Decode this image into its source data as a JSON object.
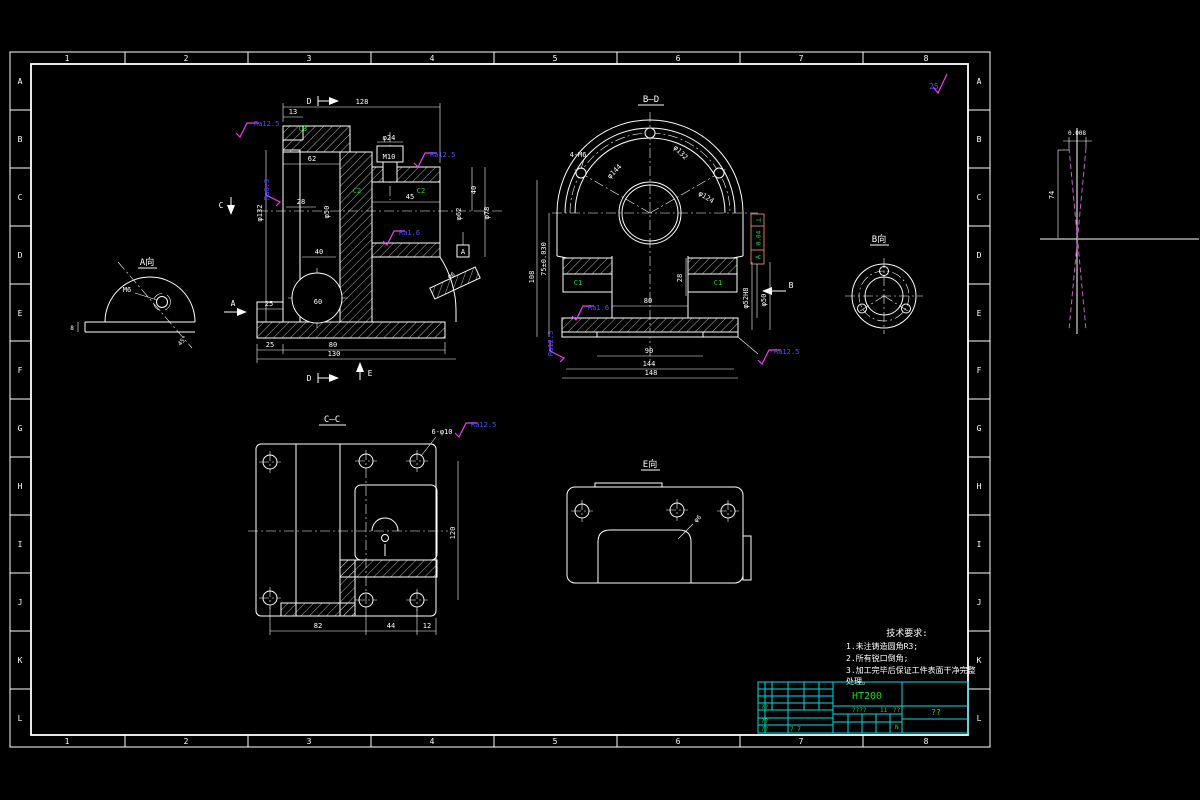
{
  "sheet": {
    "columns": [
      "1",
      "2",
      "3",
      "4",
      "5",
      "6",
      "7",
      "8"
    ],
    "rows": [
      "A",
      "B",
      "C",
      "D",
      "E",
      "F",
      "G",
      "H",
      "I",
      "J",
      "K",
      "L"
    ],
    "general_roughness": "25"
  },
  "views": {
    "front": {
      "section_d_top": "D",
      "section_d_bottom": "D",
      "section_e": "E",
      "section_c": "C",
      "view_a_arrow": "A",
      "datum": "A",
      "dims": {
        "d128": "128",
        "d13": "13",
        "d62": "62",
        "d28": "28",
        "d45": "45",
        "d40r": "40",
        "d24": "φ24",
        "m10": "M10",
        "d50": "φ50",
        "d78": "φ78",
        "d62b": "φ62",
        "d132": "φ132",
        "d40": "40",
        "d60": "60",
        "d25": "25",
        "d25b": "25",
        "d80": "80",
        "d130": "130",
        "oil": "φ6"
      },
      "chamfers": {
        "c3": "C3",
        "c2a": "C2",
        "c2b": "C2"
      },
      "finish": {
        "f1": "Ra12.5",
        "f2": "Ra6.3",
        "f3": "Ra12.5",
        "f4": "Ra1.6"
      }
    },
    "viewA": {
      "title": "A向",
      "thread": "M6",
      "angle": "45°",
      "d8": "8"
    },
    "bd": {
      "title": "B—D",
      "dims": {
        "bolt": "4-M6",
        "d144": "φ144",
        "d132": "φ132",
        "d124": "φ124",
        "h75": "75±0.030",
        "h108": "108",
        "d28": "28",
        "w80": "80",
        "w90": "90",
        "w144": "144",
        "w148": "148",
        "d52": "φ52H8",
        "d50": "φ50"
      },
      "chamfers": {
        "c1a": "C1",
        "c1b": "C1"
      },
      "gdt": {
        "sym": "⊥",
        "tol": "0.04",
        "datum": "A"
      },
      "arrow_b": "B",
      "finish": {
        "f1": "Ra12.5",
        "f2": "Ra1.6",
        "f3": "Ra12.5"
      }
    },
    "viewB": {
      "title": "B向"
    },
    "cc": {
      "title": "C—C",
      "callout": "6-φ10",
      "finish": "Ra12.5",
      "dims": {
        "w82": "82",
        "w44": "44",
        "w12": "12",
        "h120": "120"
      }
    },
    "viewE": {
      "title": "E向",
      "hole": "φ6"
    },
    "taper": {
      "tol": "0.008",
      "h74": "74"
    }
  },
  "notes": {
    "title": "技术要求:",
    "lines": [
      "1.未注铸造圆角R3;",
      "2.所有锐口倒角;",
      "3.加工完毕后保证工件表面干净完整",
      "处理。"
    ]
  },
  "title_block": {
    "material": "HT200",
    "drawing_no": "??",
    "cells": {
      "t1": "??",
      "t2": "????",
      "t3": "11",
      "t4": "??",
      "t5": "N",
      "t6": "??",
      "t7": "??",
      "t8": "7 7"
    }
  }
}
